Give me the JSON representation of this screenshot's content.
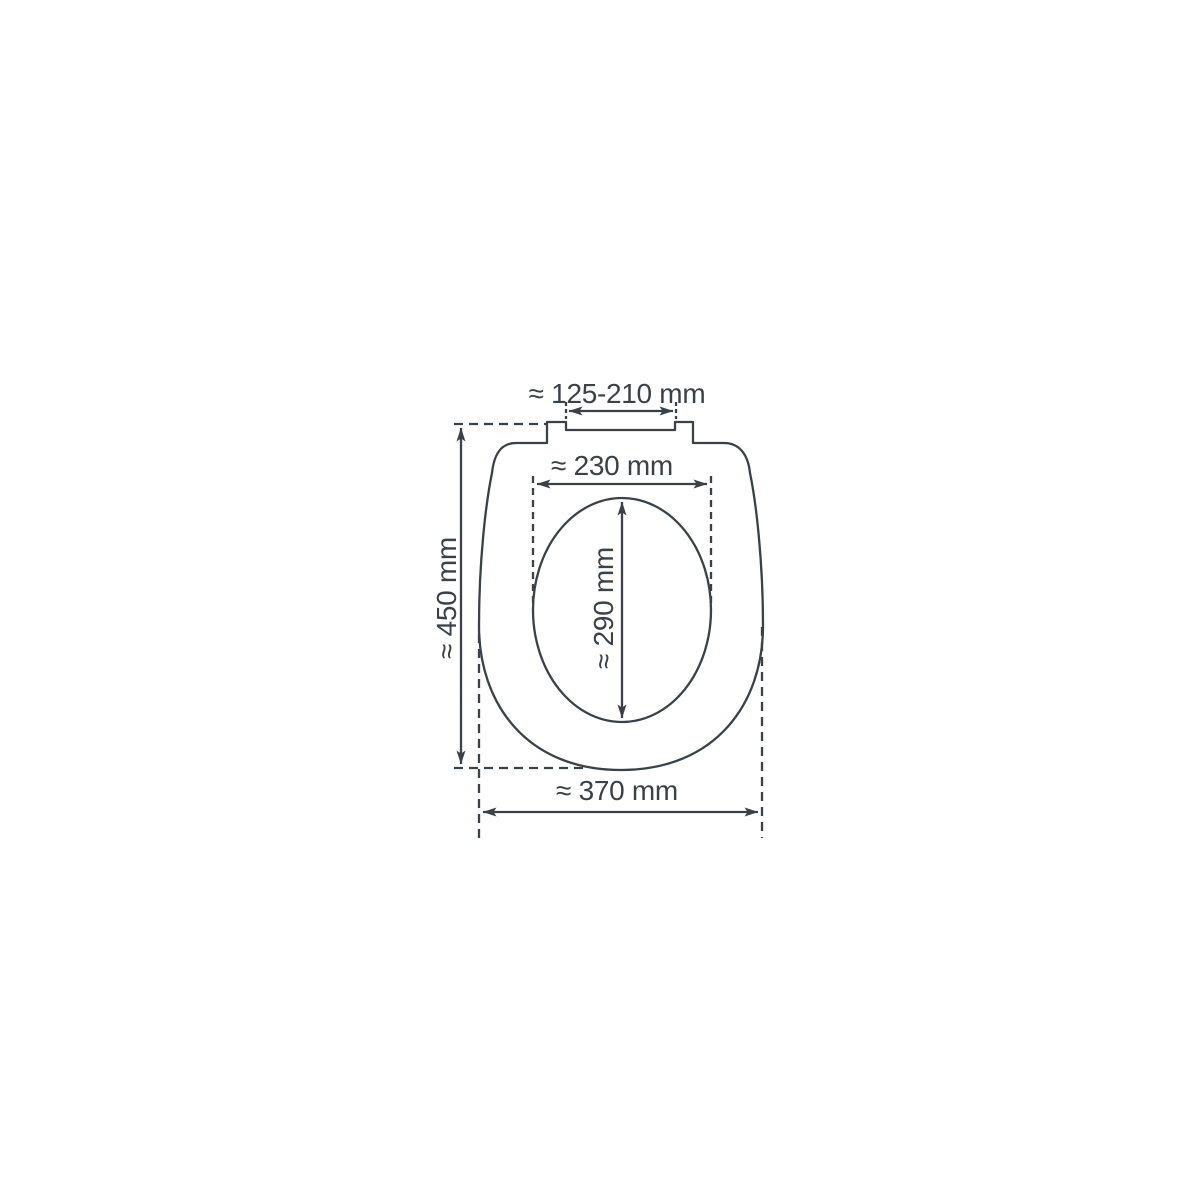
{
  "figure": {
    "kind": "technical-dimension-diagram",
    "subject": "toilet seat top view with hinge tabs, outer ring and inner opening",
    "background": "#ffffff"
  },
  "colors": {
    "line-color": "#3a4147"
  },
  "dimensions": {
    "hinge_spacing": "≈ 125-210 mm",
    "inner_width": "≈ 230 mm",
    "inner_length": "≈ 290 mm",
    "total_length": "≈ 450 mm",
    "total_width": "≈ 370 mm"
  },
  "chart_data": {
    "type": "table",
    "title": "Toilet seat dimensions (top view)",
    "measurements": [
      {
        "name": "hinge spacing",
        "value_mm": "125-210",
        "approximate": true
      },
      {
        "name": "inner opening width",
        "value_mm": "230",
        "approximate": true
      },
      {
        "name": "inner opening length",
        "value_mm": "290",
        "approximate": true
      },
      {
        "name": "total length",
        "value_mm": "450",
        "approximate": true
      },
      {
        "name": "total width",
        "value_mm": "370",
        "approximate": true
      }
    ]
  }
}
